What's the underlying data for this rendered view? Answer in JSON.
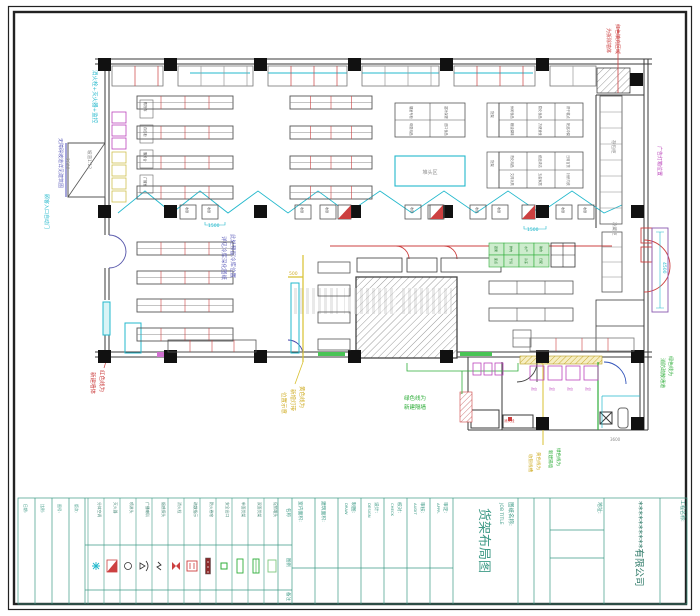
{
  "palette": {
    "wall": "#3a3a3a",
    "red": "#cc4040",
    "cyan": "#23b8cc",
    "magenta": "#bb44bb",
    "green": "#2fae3a",
    "yellow": "#d0ae28",
    "blue": "#6868c0",
    "teal": "#3e9a86",
    "gray": "#8a8a8a",
    "darkred": "#8b2a2a"
  },
  "titleblock": {
    "job_label_cn": "图纸名称:",
    "job_label_en": "JOB TITLE",
    "drawing_title": "货架布局图",
    "company": "**********有限公司",
    "project_label": "工程名称:",
    "address_label": "地址:",
    "fields": [
      {
        "cn": "制图:",
        "en": "DRAW"
      },
      {
        "cn": "设计:",
        "en": "DESIGN"
      },
      {
        "cn": "校对:",
        "en": "CHECK"
      },
      {
        "cn": "审核:",
        "en": "AUDIT"
      },
      {
        "cn": "审定:",
        "en": "APPR."
      }
    ],
    "area_fields": [
      "室内面积:",
      "建筑面积:"
    ],
    "left_fields": [
      "日期:",
      "比例:",
      "图号:",
      "版次:"
    ],
    "legend_headers": {
      "name": "名称",
      "symbol": "图例",
      "note": "备注"
    },
    "legend_items": [
      "分体空调",
      "灭火器",
      "喷淋头",
      "广播喇叭",
      "烟感探头",
      "消火栓",
      "疏散指示",
      "防火卷帘",
      "安全出口",
      "单面货架",
      "双面货架",
      "促销堆头"
    ]
  },
  "plan_labels": {
    "checkout": "收银",
    "locker": "存包柜",
    "freezer": "冷藏柜",
    "promo": "堆头区",
    "rack": "货架",
    "service_boxes": [
      "购物车",
      "存包柜",
      "服务台",
      "广播室"
    ],
    "counter_tags": [
      "款台",
      "款台",
      "款台",
      "款台"
    ],
    "shelf_table_top": [
      "烟酒专柜",
      "滋补保健",
      "母婴用品",
      "进口食品"
    ],
    "shelf_table_d1": [
      "休闲食品",
      "膨化食品",
      "饼干糕点",
      "粮油调味",
      "方便速食",
      "奶品冲调"
    ],
    "shelf_table_d2": [
      "洗化用品",
      "纸品清洁",
      "日用百货",
      "文具玩具",
      "五金家居",
      "针织内衣"
    ],
    "fresh_cells": [
      "蔬果",
      "鲜肉",
      "水产",
      "熟食",
      "面点",
      "干货",
      "冷冻",
      "日配"
    ]
  },
  "annotations": [
    {
      "name": "note-hydrant",
      "text": "消火栓+灭火器+监控",
      "x": 93,
      "y": 70,
      "fs": 5.5,
      "color": "cyan",
      "rot": true
    },
    {
      "name": "note-barrier-free",
      "text": "无障碍坡道详见建筑图",
      "x": 59,
      "y": 138,
      "fs": 5,
      "color": "blue",
      "rot": true
    },
    {
      "name": "dim-ramp",
      "text": "2600",
      "x": 66,
      "y": 158,
      "fs": 4.5,
      "color": "gray",
      "rot": true
    },
    {
      "name": "note-ramp-slope",
      "text": "坡道1:12",
      "x": 88,
      "y": 150,
      "fs": 4.5,
      "color": "gray",
      "rot": true
    },
    {
      "name": "note-entrance",
      "text": "顾客入口自动门",
      "x": 45,
      "y": 194,
      "fs": 5,
      "color": "cyan",
      "rot": true
    },
    {
      "name": "note-coldroom-1",
      "text": "此处预留冷库位置",
      "x": 231,
      "y": 234,
      "fs": 5.5,
      "color": "blue",
      "rot": true
    },
    {
      "name": "note-coldroom-2",
      "text": "详见冷库深化图纸",
      "x": 222,
      "y": 236,
      "fs": 5.5,
      "color": "blue",
      "rot": true
    },
    {
      "name": "note-red-wall-1",
      "text": "红色线为",
      "x": 100,
      "y": 370,
      "fs": 5.5,
      "color": "red",
      "rot": true
    },
    {
      "name": "note-red-wall-2",
      "text": "新建墙体",
      "x": 91,
      "y": 372,
      "fs": 5.5,
      "color": "red",
      "rot": true
    },
    {
      "name": "note-demolish-1",
      "text": "红色填充区域",
      "x": 616,
      "y": 24,
      "fs": 5,
      "color": "red",
      "rot": true
    },
    {
      "name": "note-demolish-2",
      "text": "为拆除墙体",
      "x": 607,
      "y": 28,
      "fs": 5,
      "color": "red",
      "rot": true
    },
    {
      "name": "note-lightbox",
      "text": "广告灯箱位置",
      "x": 658,
      "y": 146,
      "fs": 5,
      "color": "magenta",
      "rot": true
    },
    {
      "name": "dim-platform",
      "text": "4500",
      "x": 663,
      "y": 262,
      "fs": 4.5,
      "color": "cyan",
      "rot": true
    },
    {
      "name": "note-exit-green-1",
      "text": "绿色线为",
      "x": 669,
      "y": 356,
      "fs": 5,
      "color": "green",
      "rot": true
    },
    {
      "name": "note-exit-green-2",
      "text": "消防疏散通道",
      "x": 661,
      "y": 358,
      "fs": 5,
      "color": "green",
      "rot": true
    },
    {
      "name": "note-yellow-1",
      "text": "黄色线为",
      "x": 300,
      "y": 386,
      "fs": 5.5,
      "color": "yellow",
      "rot": true
    },
    {
      "name": "note-yellow-2",
      "text": "新增灯带",
      "x": 291,
      "y": 389,
      "fs": 5.5,
      "color": "yellow",
      "rot": true
    },
    {
      "name": "note-yellow-3",
      "text": "位置示意",
      "x": 282,
      "y": 392,
      "fs": 5.5,
      "color": "yellow",
      "rot": true
    },
    {
      "name": "note-green-wall-1",
      "text": "绿色线为",
      "x": 415,
      "y": 400,
      "fs": 5.5,
      "color": "green",
      "rot": false,
      "mid": true
    },
    {
      "name": "note-green-wall-2",
      "text": "新建隔墙",
      "x": 415,
      "y": 409,
      "fs": 5.5,
      "color": "green",
      "rot": false,
      "mid": true
    },
    {
      "name": "note-yellow-b1",
      "text": "黄色线为",
      "x": 537,
      "y": 452,
      "fs": 4.5,
      "color": "yellow",
      "rot": true
    },
    {
      "name": "note-yellow-b2",
      "text": "收银线槽",
      "x": 529,
      "y": 454,
      "fs": 4.5,
      "color": "yellow",
      "rot": true
    },
    {
      "name": "note-green-b1",
      "text": "绿色线为",
      "x": 557,
      "y": 448,
      "fs": 4.5,
      "color": "green",
      "rot": true
    },
    {
      "name": "note-green-b2",
      "text": "新建隔墙",
      "x": 549,
      "y": 450,
      "fs": 4.5,
      "color": "green",
      "rot": true
    },
    {
      "name": "dim-aisle-1",
      "text": "1500",
      "x": 208,
      "y": 227,
      "fs": 4.5,
      "color": "cyan",
      "rot": false
    },
    {
      "name": "dim-aisle-2",
      "text": "1500",
      "x": 527,
      "y": 231,
      "fs": 4.5,
      "color": "cyan",
      "rot": false
    },
    {
      "name": "dim-shelf",
      "text": "500",
      "x": 289,
      "y": 275,
      "fs": 4.5,
      "color": "yellow",
      "rot": false
    },
    {
      "name": "label-locker",
      "text": "存包柜",
      "x": 612,
      "y": 140,
      "fs": 4.5,
      "color": "gray",
      "rot": true
    },
    {
      "name": "label-freezer",
      "text": "冷藏柜",
      "x": 613,
      "y": 222,
      "fs": 4.5,
      "color": "gray",
      "rot": true
    },
    {
      "name": "label-promo",
      "text": "堆头区",
      "x": 430,
      "y": 174,
      "fs": 5,
      "color": "gray",
      "rot": false,
      "mid": true
    },
    {
      "name": "label-hydrant-annex",
      "text": "消火栓",
      "x": 504,
      "y": 422,
      "fs": 3.5,
      "color": "red",
      "rot": false
    },
    {
      "name": "dim-annex",
      "text": "3600",
      "x": 610,
      "y": 441,
      "fs": 4,
      "color": "gray",
      "rot": false
    }
  ]
}
